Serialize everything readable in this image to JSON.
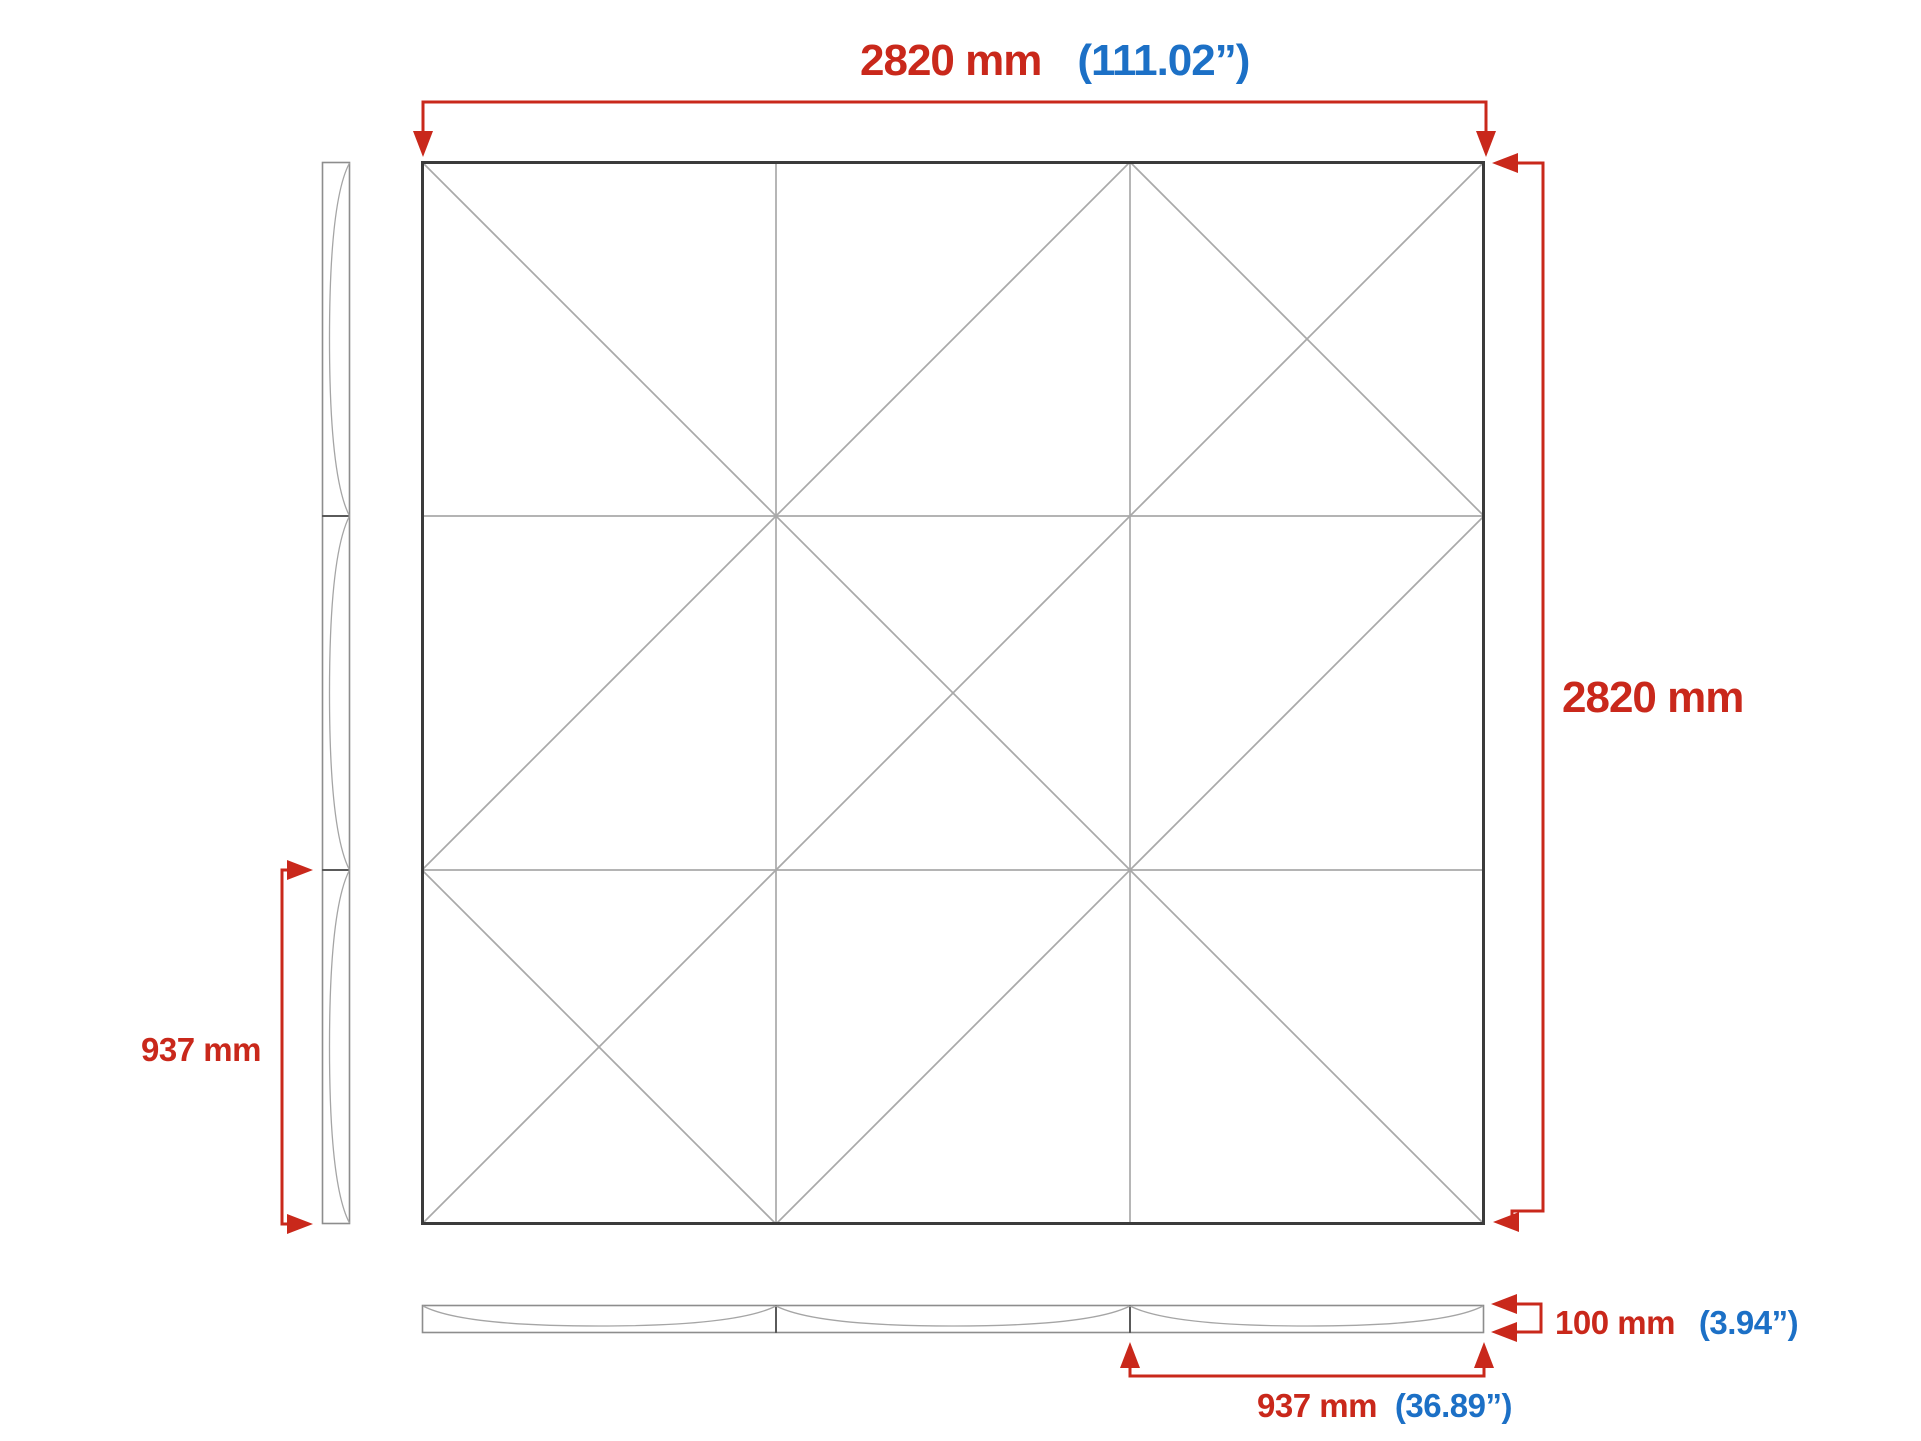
{
  "colors": {
    "dimension_red": "#c9281b",
    "inch_blue": "#1c70c6",
    "outline_dark": "#3b3b3b",
    "line_gray": "#a9a9a9",
    "profile_gray": "#8d8d8d",
    "divider_gray": "#5a5a5a",
    "curve_gray": "#a5a5a5"
  },
  "dimensions": {
    "width": {
      "mm": "2820 mm",
      "inch": "(111.02”)"
    },
    "height": {
      "mm": "2820 mm"
    },
    "tile_height": {
      "mm": "937 mm"
    },
    "thickness": {
      "mm": "100 mm",
      "inch": "(3.94”)"
    },
    "tile_width": {
      "mm": "937 mm",
      "inch": "(36.89”)"
    }
  },
  "front_view": {
    "rows": 3,
    "cols": 3
  }
}
